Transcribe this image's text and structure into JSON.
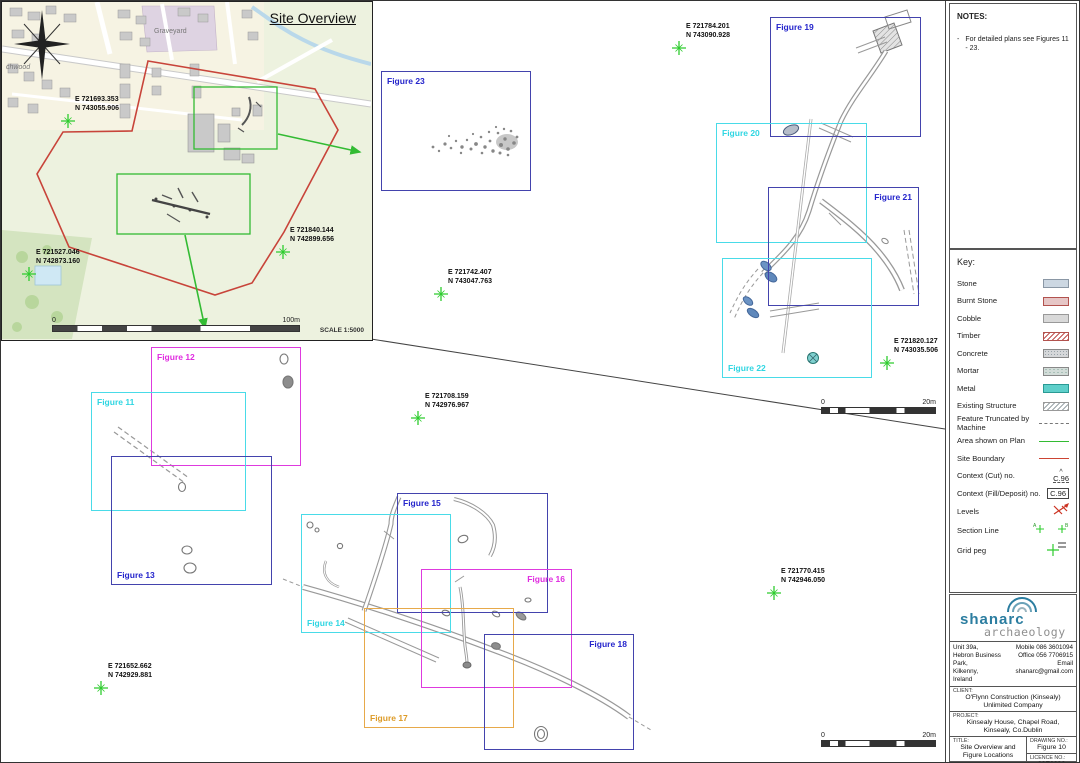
{
  "colors": {
    "navy": "#4343ad",
    "navy_text": "#2525cc",
    "cyan": "#49dbe8",
    "cyan_text": "#2fd6e2",
    "magenta": "#de3ade",
    "magenta_text": "#e02ce0",
    "orange": "#e7a94a",
    "orange_text": "#dd9b28",
    "green": "#33bb33",
    "red_boundary": "#c8443a",
    "peg_green": "#2ecc2e"
  },
  "notes": {
    "heading": "NOTES:",
    "bullet": "-",
    "items": [
      "For detailed plans see Figures 11 - 23."
    ]
  },
  "key": {
    "heading": "Key:",
    "items": [
      {
        "label": "Stone",
        "swatch": "stone"
      },
      {
        "label": "Burnt Stone",
        "swatch": "burnt-stone"
      },
      {
        "label": "Cobble",
        "swatch": "cobble"
      },
      {
        "label": "Timber",
        "swatch": "timber"
      },
      {
        "label": "Concrete",
        "swatch": "concrete"
      },
      {
        "label": "Mortar",
        "swatch": "mortar"
      },
      {
        "label": "Metal",
        "swatch": "metal"
      },
      {
        "label": "Existing Structure",
        "swatch": "existing-structure"
      },
      {
        "label": "Feature Truncated by Machine",
        "swatch": "truncated-line"
      },
      {
        "label": "Area shown on Plan",
        "swatch": "green-line"
      },
      {
        "label": "Site Boundary",
        "swatch": "red-line"
      },
      {
        "label": "Context (Cut) no.",
        "swatch": "context-cut",
        "value": "C.96",
        "caret": "^"
      },
      {
        "label": "Context (Fill/Deposit) no.",
        "swatch": "context-fill",
        "value": "C.96"
      },
      {
        "label": "Levels",
        "swatch": "levels"
      },
      {
        "label": "Section Line",
        "swatch": "section-line",
        "value_a": "A",
        "value_b": "B"
      },
      {
        "label": "Grid peg",
        "swatch": "grid-peg"
      }
    ]
  },
  "title_block": {
    "logo_line1": "shanarc",
    "logo_line2": "archaeology",
    "address": [
      "Unit 39a,",
      "Hebron Business Park,",
      "Kilkenny,",
      "Ireland"
    ],
    "contact": [
      "Mobile 086 3601094",
      "Office 056 7706915",
      "Email shanarc@gmail.com"
    ],
    "client_label": "CLIENT:",
    "client": "O'Flynn Construction (Kinsealy) Unlimited Company",
    "project_label": "PROJECT:",
    "project": "Kinsealy House, Chapel Road, Kinsealy, Co.Dublin",
    "title_label": "TITLE:",
    "title": "Site Overview and Figure Locations",
    "drawing_no_label": "DRAWING NO.:",
    "drawing_no": "Figure 10",
    "licence_no_label": "LICENCE NO.:",
    "licence_no": "20E0236",
    "date_label": "DATE:",
    "date": "27/09/2022",
    "scale_label": "SCALE:",
    "scale": "1:500",
    "produced_by_label": "PRODUCED BY:",
    "produced_by": "M.G."
  },
  "site_overview": {
    "title": "Site Overview",
    "scale_text": "SCALE 1:5000",
    "scalebar": {
      "start": "0",
      "end": "100m"
    },
    "map_labels": [
      {
        "text": "Graveyard",
        "x": 152,
        "y": 28
      },
      {
        "text": "chwood",
        "x": 4,
        "y": 64
      }
    ],
    "pegs": [
      {
        "e": "E 721693.353",
        "n": "N 743055.906",
        "x": 66,
        "y": 119
      },
      {
        "e": "E 721527.046",
        "n": "N 742873.160",
        "x": 27,
        "y": 272
      },
      {
        "e": "E 721840.144",
        "n": "N 742899.656",
        "x": 281,
        "y": 250
      }
    ]
  },
  "plan": {
    "figures": [
      {
        "label": "Figure 23",
        "color": "navy",
        "x": 380,
        "y": 70,
        "w": 150,
        "h": 120,
        "label_pos": "tl"
      },
      {
        "label": "Figure 19",
        "color": "navy",
        "x": 769,
        "y": 16,
        "w": 151,
        "h": 120,
        "label_pos": "tl"
      },
      {
        "label": "Figure 20",
        "color": "cyan",
        "x": 715,
        "y": 122,
        "w": 151,
        "h": 120,
        "label_pos": "tl"
      },
      {
        "label": "Figure 21",
        "color": "navy",
        "x": 767,
        "y": 186,
        "w": 151,
        "h": 119,
        "label_pos": "tr"
      },
      {
        "label": "Figure 22",
        "color": "cyan",
        "x": 721,
        "y": 257,
        "w": 150,
        "h": 120,
        "label_pos": "bl"
      },
      {
        "label": "Figure 12",
        "color": "magenta",
        "x": 150,
        "y": 346,
        "w": 150,
        "h": 119,
        "label_pos": "tl"
      },
      {
        "label": "Figure 11",
        "color": "cyan",
        "x": 90,
        "y": 391,
        "w": 155,
        "h": 119,
        "label_pos": "tl"
      },
      {
        "label": "Figure 13",
        "color": "navy",
        "x": 110,
        "y": 455,
        "w": 161,
        "h": 129,
        "label_pos": "bl"
      },
      {
        "label": "Figure 15",
        "color": "navy",
        "x": 396,
        "y": 492,
        "w": 151,
        "h": 120,
        "label_pos": "tl"
      },
      {
        "label": "Figure 14",
        "color": "cyan",
        "x": 300,
        "y": 513,
        "w": 150,
        "h": 119,
        "label_pos": "bl"
      },
      {
        "label": "Figure 16",
        "color": "magenta",
        "x": 420,
        "y": 568,
        "w": 151,
        "h": 119,
        "label_pos": "tr"
      },
      {
        "label": "Figure 17",
        "color": "orange",
        "x": 363,
        "y": 607,
        "w": 150,
        "h": 120,
        "label_pos": "bl"
      },
      {
        "label": "Figure 18",
        "color": "navy",
        "x": 483,
        "y": 633,
        "w": 150,
        "h": 116,
        "label_pos": "tr"
      }
    ],
    "pegs": [
      {
        "e": "E 721784.201",
        "n": "N 743090.928",
        "x": 678,
        "y": 47
      },
      {
        "e": "E 721742.407",
        "n": "N 743047.763",
        "x": 440,
        "y": 293
      },
      {
        "e": "E 721820.127",
        "n": "N 743035.506",
        "x": 886,
        "y": 362
      },
      {
        "e": "E 721708.159",
        "n": "N 742976.967",
        "x": 417,
        "y": 417
      },
      {
        "e": "E 721770.415",
        "n": "N 742946.050",
        "x": 773,
        "y": 592
      },
      {
        "e": "E 721652.662",
        "n": "N 742929.881",
        "x": 100,
        "y": 687
      }
    ],
    "scalebars": [
      {
        "start": "0",
        "end": "20m",
        "x": 820,
        "y": 398
      },
      {
        "start": "0",
        "end": "20m",
        "x": 820,
        "y": 731
      }
    ]
  }
}
